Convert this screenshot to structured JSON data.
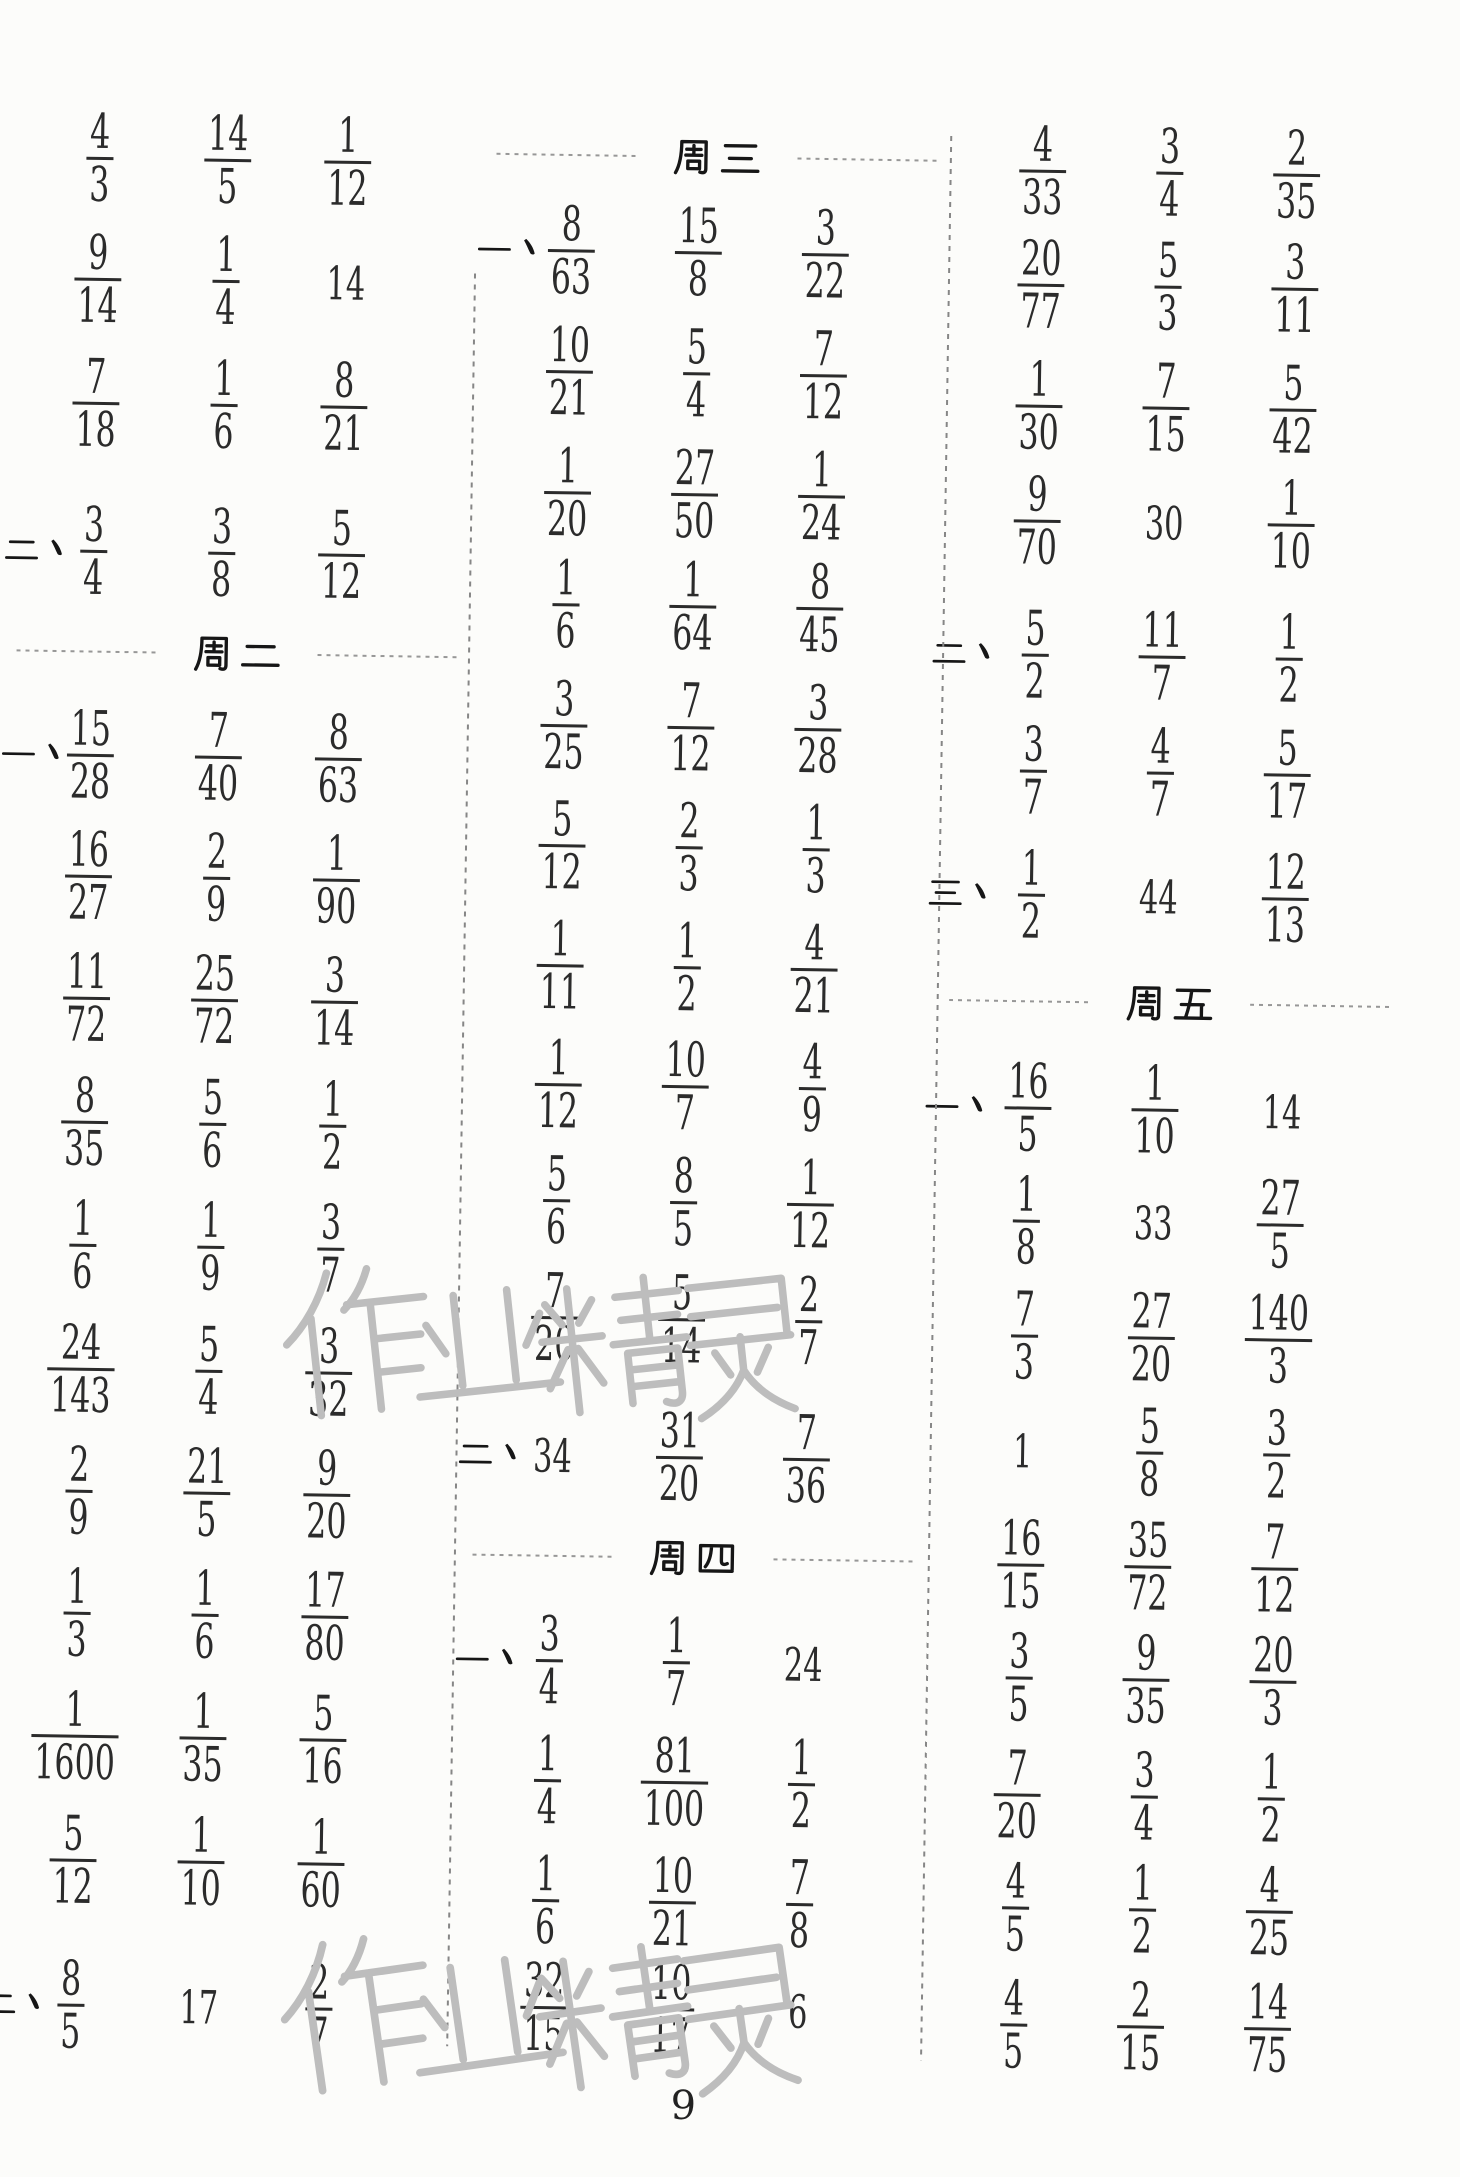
{
  "page_number": "9",
  "watermark_text": "作业精灵",
  "colors": {
    "ink": "#2b2b2b",
    "watermark_gray": "#bdbdbd"
  },
  "headers": {
    "week2": "周二",
    "week3": "周三",
    "week4": "周四",
    "week5": "周五"
  },
  "labels": {
    "one": "一、",
    "two": "二、",
    "three": "三、"
  },
  "columns": [
    {
      "x_centers": [
        100,
        228,
        348
      ],
      "label_x": 46,
      "rows": [
        {
          "y": 168,
          "cells": [
            "4/3",
            "14/5",
            "1/12"
          ]
        },
        {
          "y": 289,
          "cells": [
            "9/14",
            "1/4",
            "14"
          ]
        },
        {
          "y": 413,
          "cells": [
            "7/18",
            "1/6",
            "8/21"
          ]
        },
        {
          "y": 561,
          "label": "二、",
          "cells": [
            "3/4",
            "3/8",
            "5/12"
          ]
        },
        {
          "y": 661,
          "header": "周二",
          "hx": 245
        },
        {
          "y": 765,
          "label": "一、",
          "cells": [
            "15/28",
            "7/40",
            "8/63"
          ]
        },
        {
          "y": 886,
          "cells": [
            "16/27",
            "2/9",
            "1/90"
          ]
        },
        {
          "y": 1008,
          "cells": [
            "11/72",
            "25/72",
            "3/14"
          ]
        },
        {
          "y": 1132,
          "cells": [
            "8/35",
            "5/6",
            "1/2"
          ]
        },
        {
          "y": 1255,
          "cells": [
            "1/6",
            "1/9",
            "3/7"
          ]
        },
        {
          "y": 1379,
          "cells": [
            "24/143",
            "5/4",
            "3/32"
          ]
        },
        {
          "y": 1501,
          "cells": [
            "2/9",
            "21/5",
            "9/20"
          ]
        },
        {
          "y": 1623,
          "cells": [
            "1/3",
            "1/6",
            "17/80"
          ]
        },
        {
          "y": 1746,
          "cells": [
            "1/1600",
            "1/35",
            "5/16"
          ]
        },
        {
          "y": 1870,
          "cells": [
            "5/12",
            "1/10",
            "1/60"
          ]
        },
        {
          "y": 2015,
          "label": "二、",
          "cells": [
            "8/5",
            "17",
            "2/7"
          ]
        }
      ]
    },
    {
      "x_centers": [
        573,
        700,
        827
      ],
      "label_x": 514,
      "rows": [
        {
          "y": 157,
          "header": "周三",
          "hx": 717
        },
        {
          "y": 253,
          "label": "一、",
          "cells": [
            "8/63",
            "15/8",
            "3/22"
          ]
        },
        {
          "y": 374,
          "cells": [
            "10/21",
            "5/4",
            "7/12"
          ]
        },
        {
          "y": 495,
          "cells": [
            "1/20",
            "27/50",
            "1/24"
          ]
        },
        {
          "y": 607,
          "cells": [
            "1/6",
            "1/64",
            "8/45"
          ]
        },
        {
          "y": 728,
          "cells": [
            "3/25",
            "7/12",
            "3/28"
          ]
        },
        {
          "y": 848,
          "cells": [
            "5/12",
            "2/3",
            "1/3"
          ]
        },
        {
          "y": 968,
          "cells": [
            "1/11",
            "1/2",
            "4/21"
          ]
        },
        {
          "y": 1087,
          "cells": [
            "1/12",
            "10/7",
            "4/9"
          ]
        },
        {
          "y": 1203,
          "cells": [
            "5/6",
            "8/5",
            "1/12"
          ]
        },
        {
          "y": 1320,
          "cells": [
            "7/20",
            "5/14",
            "2/7"
          ]
        },
        {
          "y": 1458,
          "label": "二、",
          "cells": [
            "34",
            "31/20",
            "7/36"
          ]
        },
        {
          "y": 1558,
          "header": "周四",
          "hx": 715
        },
        {
          "y": 1663,
          "label": "一、",
          "cells": [
            "3/4",
            "1/7",
            "24"
          ]
        },
        {
          "y": 1783,
          "cells": [
            "1/4",
            "81/100",
            "1/2"
          ]
        },
        {
          "y": 1903,
          "cells": [
            "1/6",
            "10/21",
            "7/8"
          ]
        },
        {
          "y": 2010,
          "cells": [
            "32/15",
            "10/17",
            "6"
          ]
        }
      ]
    },
    {
      "x_centers": [
        1043,
        1170,
        1297
      ],
      "label_x": 975,
      "rows": [
        {
          "y": 166,
          "cells": [
            "4/33",
            "3/4",
            "2/35"
          ]
        },
        {
          "y": 280,
          "cells": [
            "20/77",
            "5/3",
            "3/11"
          ]
        },
        {
          "y": 401,
          "cells": [
            "1/30",
            "7/15",
            "5/42"
          ]
        },
        {
          "y": 516,
          "cells": [
            "9/70",
            "30",
            "1/10"
          ]
        },
        {
          "y": 650,
          "label": "二、",
          "cells": [
            "5/2",
            "11/7",
            "1/2"
          ]
        },
        {
          "y": 766,
          "cells": [
            "3/7",
            "4/7",
            "5/17"
          ]
        },
        {
          "y": 890,
          "label": "三、",
          "cells": [
            "1/2",
            "44",
            "12/13"
          ]
        },
        {
          "y": 996,
          "header": "周五",
          "hx": 1183
        },
        {
          "y": 1103,
          "label": "一、",
          "cells": [
            "16/5",
            "1/10",
            "14"
          ]
        },
        {
          "y": 1216,
          "cells": [
            "1/8",
            "33",
            "27/5"
          ]
        },
        {
          "y": 1331,
          "cells": [
            "7/3",
            "27/20",
            "140/3"
          ]
        },
        {
          "y": 1446,
          "cells": [
            "1",
            "5/8",
            "3/2"
          ]
        },
        {
          "y": 1560,
          "cells": [
            "16/15",
            "35/72",
            "7/12"
          ]
        },
        {
          "y": 1673,
          "cells": [
            "3/5",
            "9/35",
            "20/3"
          ]
        },
        {
          "y": 1790,
          "cells": [
            "7/20",
            "3/4",
            "1/2"
          ]
        },
        {
          "y": 1903,
          "cells": [
            "4/5",
            "1/2",
            "4/25"
          ]
        },
        {
          "y": 2020,
          "cells": [
            "4/5",
            "2/15",
            "14/75"
          ]
        }
      ]
    }
  ],
  "dividers": [
    {
      "x": 477,
      "y1": 277,
      "y2": 2050
    },
    {
      "x": 951,
      "y1": 132,
      "y2": 2057
    }
  ],
  "watermarks": [
    {
      "x": 292,
      "y": 1262,
      "size": 168,
      "advance": 128,
      "char_rotate": -7
    },
    {
      "x": 300,
      "y": 1932,
      "size": 172,
      "advance": 128,
      "char_rotate": -9
    }
  ],
  "page_number_pos": {
    "x": 714,
    "y": 2106
  }
}
